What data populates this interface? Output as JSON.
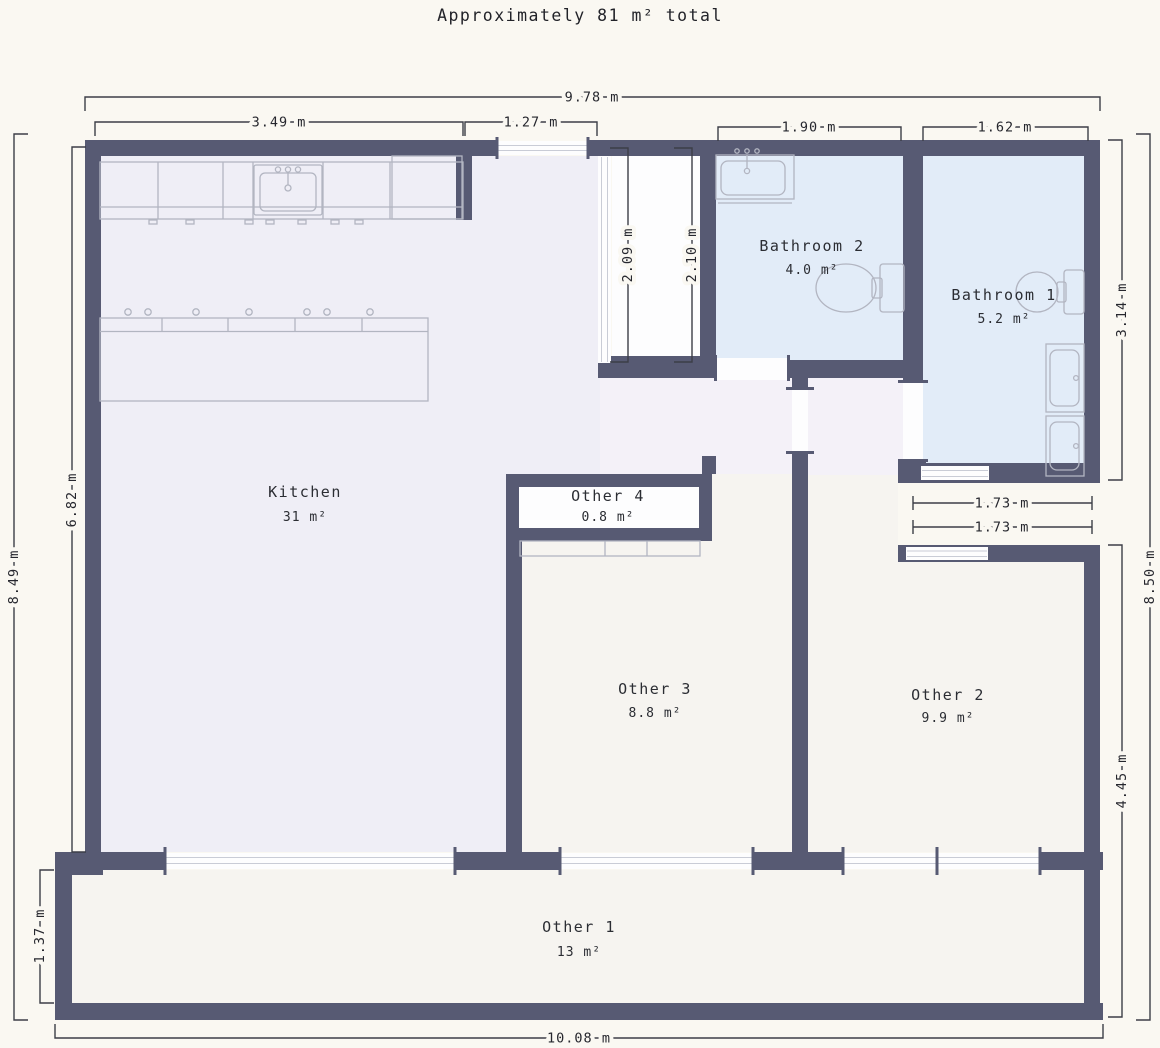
{
  "title": "Approximately 81 m² total",
  "colors": {
    "bg": "#faf8f2",
    "wall": "#575a73",
    "kitchenFloor": "#efeef6",
    "hallFloor": "#f4f1f8",
    "bathFloor": "#e2ecf8",
    "otherFloor": "#f6f4f0",
    "openFill": "#fdfdfe",
    "fixture": "#b2b5c1",
    "dimLine": "#3c3e47",
    "dimText": "#26272e",
    "roomText": "#2b2d33"
  },
  "rooms": {
    "kitchen": {
      "name": "Kitchen",
      "area": "31 m²"
    },
    "bathroom2": {
      "name": "Bathroom 2",
      "area": "4.0 m²"
    },
    "bathroom1": {
      "name": "Bathroom 1",
      "area": "5.2 m²"
    },
    "other4": {
      "name": "Other 4",
      "area": "0.8 m²"
    },
    "other3": {
      "name": "Other 3",
      "area": "8.8 m²"
    },
    "other2": {
      "name": "Other 2",
      "area": "9.9 m²"
    },
    "other1": {
      "name": "Other 1",
      "area": "13 m²"
    }
  },
  "dimensions": {
    "top_total": "9.78 m",
    "kitchen_top": "3.49 m",
    "entry_window": "1.27 m",
    "bathroom2_width": "1.90 m",
    "bathroom1_width": "1.62 m",
    "left_total": "8.49 m",
    "kitchen_left": "6.82 m",
    "other1_left": "1.37 m",
    "vestibule_left": "2.09 m",
    "vestibule_right": "2.10 m",
    "bathrooms_right": "3.14 m",
    "right_total": "8.50 m",
    "other2_right": "4.45 m",
    "bathroom1_bottom": "1.73 m",
    "other2_top": "1.73 m",
    "bottom_total": "10.08 m"
  },
  "fixtures": [
    "kitchen-counter",
    "kitchen-sink",
    "kitchen-island",
    "bathroom2-sink",
    "bathroom2-toilet",
    "bathroom1-toilet",
    "bathroom1-sinks",
    "other3-closet"
  ]
}
